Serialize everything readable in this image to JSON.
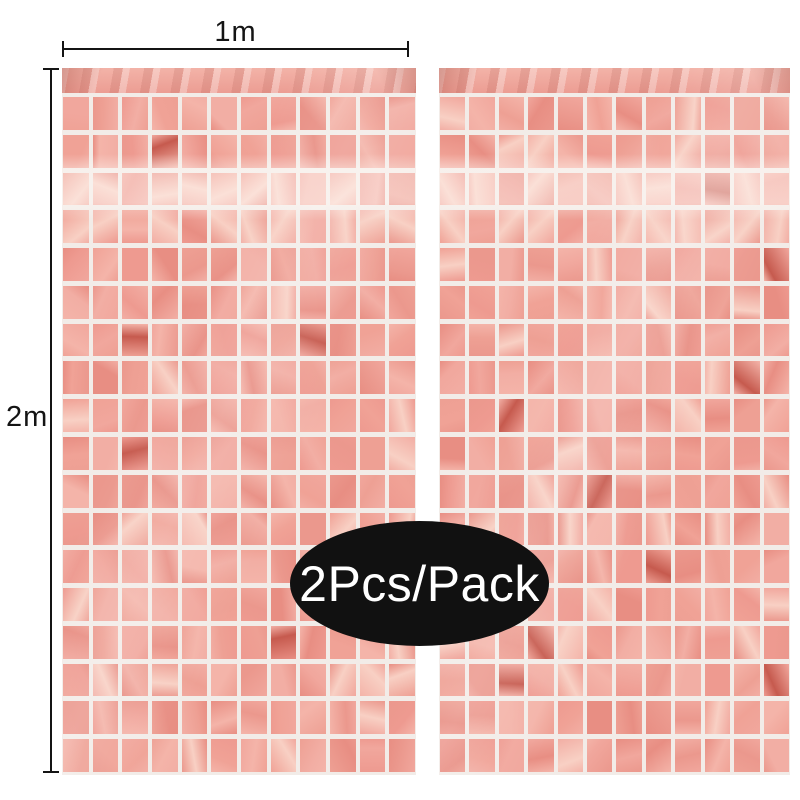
{
  "annotations": {
    "width_label": "1m",
    "height_label": "2m"
  },
  "badge": {
    "label": "2Pcs/Pack",
    "background": "#111111",
    "text_color": "#ffffff"
  },
  "curtains": {
    "panel_count": 2
  },
  "colors": {
    "background": "#ffffff",
    "annotation_color": "#141414",
    "grid_line": "#f2ece8",
    "foil_band_light": "#f3b3a8",
    "foil_band_base": "#ec9d93",
    "foil_palette": [
      "#f1a79d",
      "#eea094",
      "#f4b4a9",
      "#eb988d",
      "#f2aea4",
      "#e88e83",
      "#ee9a90",
      "#f0a296"
    ],
    "foil_highlight": "#f8d0c4",
    "foil_accent_dark": "#c65a4e"
  }
}
